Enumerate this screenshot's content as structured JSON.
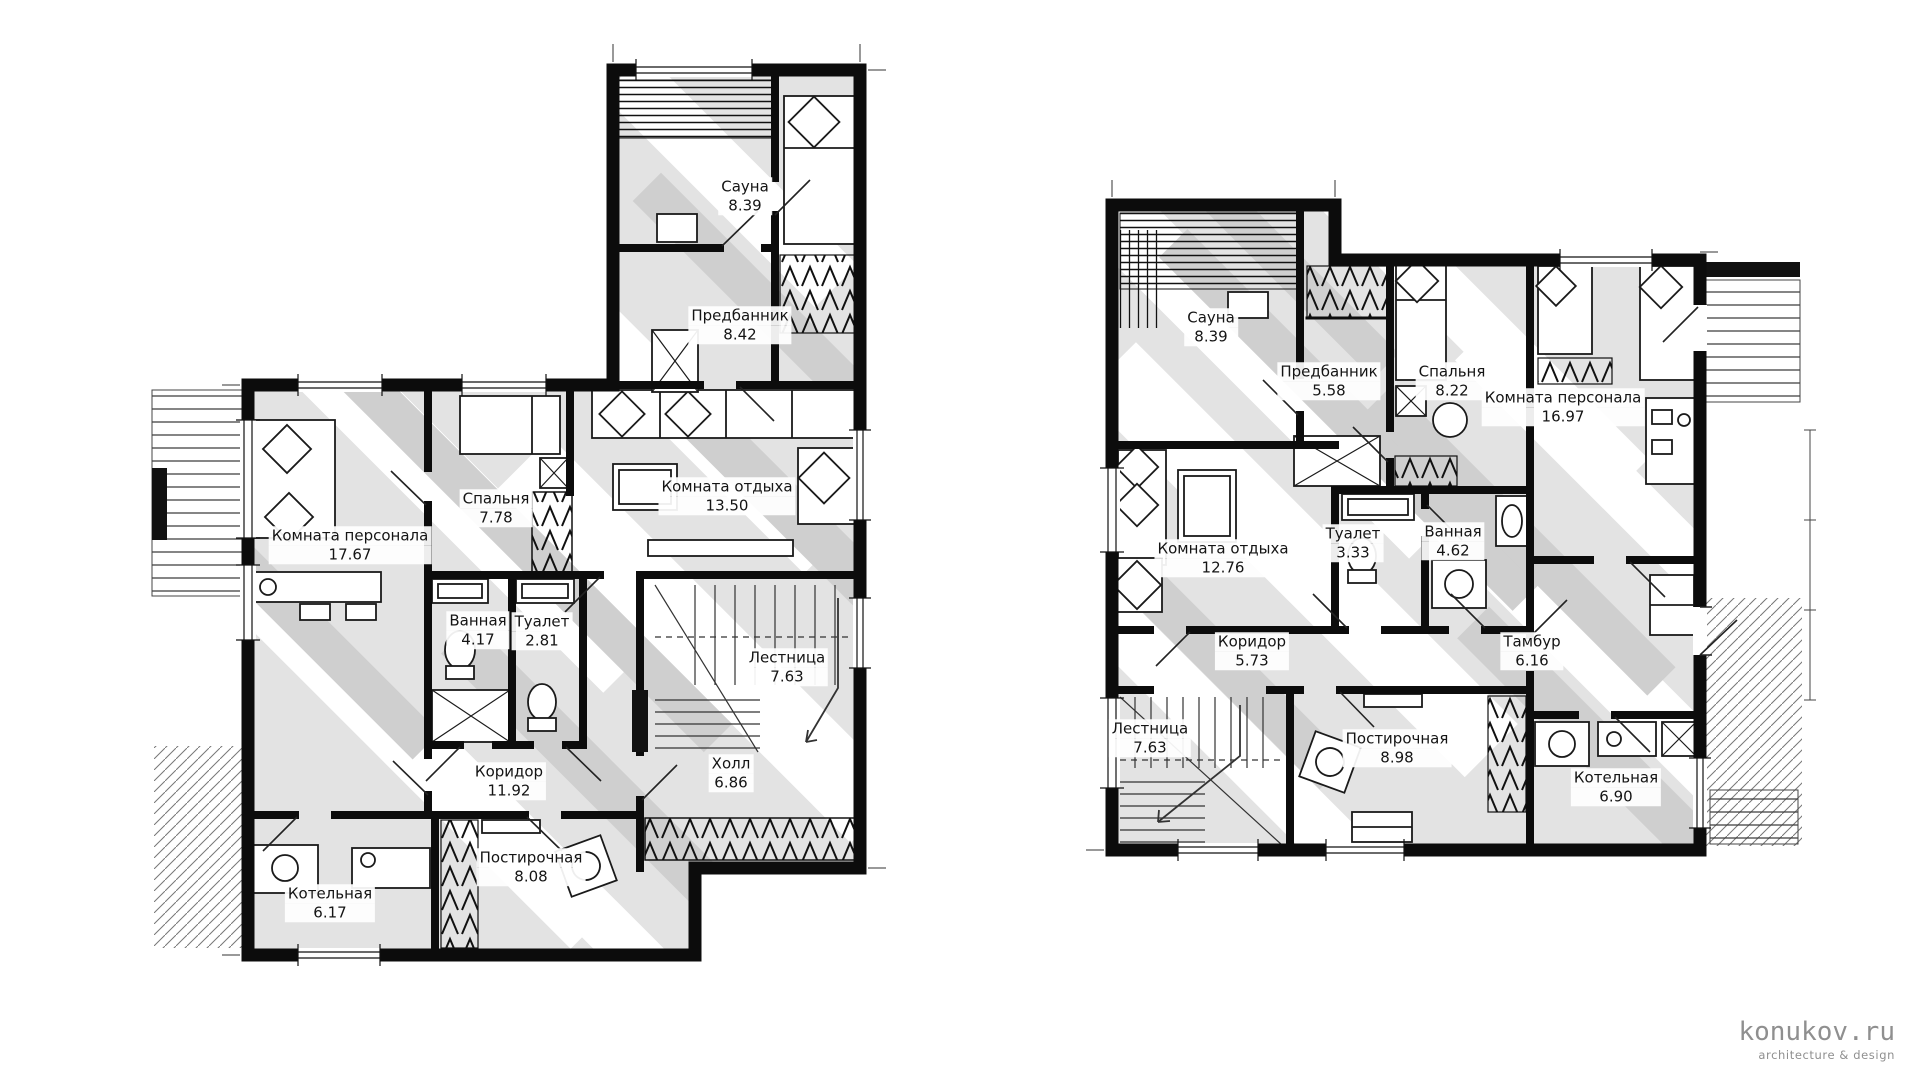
{
  "watermark": {
    "title": "konukov.ru",
    "subtitle": "architecture & design",
    "color": "#8f8f8f"
  },
  "colors": {
    "wall": "#0c0c0c",
    "floor": "#e3e3e3",
    "shadow": "#cfcfcf",
    "highlight": "#ffffff",
    "line": "#1a1a1a"
  },
  "plans": [
    {
      "id": "plan-1",
      "rooms": [
        {
          "name": "Сауна",
          "area": "8.39"
        },
        {
          "name": "Предбанник",
          "area": "8.42"
        },
        {
          "name": "Комната персонала",
          "area": "17.67"
        },
        {
          "name": "Спальня",
          "area": "7.78"
        },
        {
          "name": "Комната отдыха",
          "area": "13.50"
        },
        {
          "name": "Ванная",
          "area": "4.17"
        },
        {
          "name": "Туалет",
          "area": "2.81"
        },
        {
          "name": "Лестница",
          "area": "7.63"
        },
        {
          "name": "Коридор",
          "area": "11.92"
        },
        {
          "name": "Холл",
          "area": "6.86"
        },
        {
          "name": "Котельная",
          "area": "6.17"
        },
        {
          "name": "Постирочная",
          "area": "8.08"
        }
      ]
    },
    {
      "id": "plan-2",
      "rooms": [
        {
          "name": "Сауна",
          "area": "8.39"
        },
        {
          "name": "Предбанник",
          "area": "5.58"
        },
        {
          "name": "Спальня",
          "area": "8.22"
        },
        {
          "name": "Комната персонала",
          "area": "16.97"
        },
        {
          "name": "Комната отдыха",
          "area": "12.76"
        },
        {
          "name": "Туалет",
          "area": "3.33"
        },
        {
          "name": "Ванная",
          "area": "4.62"
        },
        {
          "name": "Коридор",
          "area": "5.73"
        },
        {
          "name": "Тамбур",
          "area": "6.16"
        },
        {
          "name": "Лестница",
          "area": "7.63"
        },
        {
          "name": "Постирочная",
          "area": "8.98"
        },
        {
          "name": "Котельная",
          "area": "6.90"
        }
      ]
    }
  ]
}
